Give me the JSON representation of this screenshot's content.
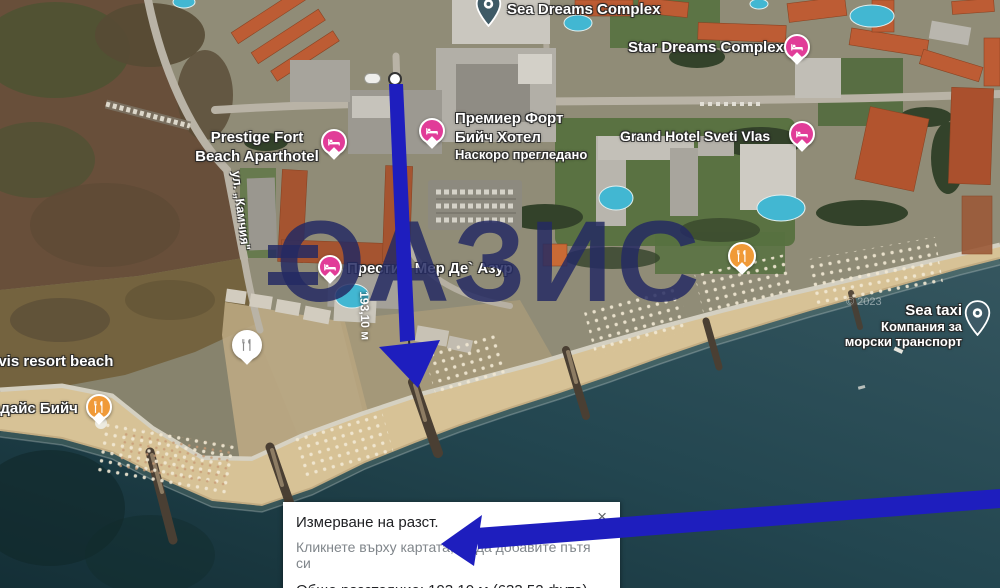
{
  "colors": {
    "lodging_pin": "#e13c98",
    "restaurant_pin": "#f09a38",
    "drop_pin": "#3e5a66",
    "arrow_blue": "#1e1ebe",
    "watermark_navy": "#242a63"
  },
  "map": {
    "watermark": "ОАЗИС",
    "copyright": "© 2023",
    "labels": {
      "sea_dreams": "Sea Dreams Complex",
      "star_dreams": "Star Dreams Complex",
      "prestige_fort_1": "Prestige Fort",
      "prestige_fort_2": "Beach Aparthotel",
      "premier_fort_1": "Премиер Форт",
      "premier_fort_2": "Бийч Хотел",
      "recently_viewed": "Наскоро прегледано",
      "grand_hotel": "Grand Hotel Sveti Vlas",
      "prestige_mer": "Престиж Мер Де` Азур",
      "sea_taxi": "Sea taxi",
      "sea_taxi_2": "Компания за",
      "sea_taxi_3": "морски транспорт",
      "nevis": "evis resort beach",
      "paradise": "адайс Бийч",
      "street": "ул. „Камчия\""
    },
    "measurement": {
      "distance": "193,10 м"
    }
  },
  "dialog": {
    "title": "Измерване на разст.",
    "hint": "Кликнете върху картата, за да добавите пътя си",
    "total": "Общо разстояние: 193,10 м (633,52 фута)",
    "close": "×"
  }
}
